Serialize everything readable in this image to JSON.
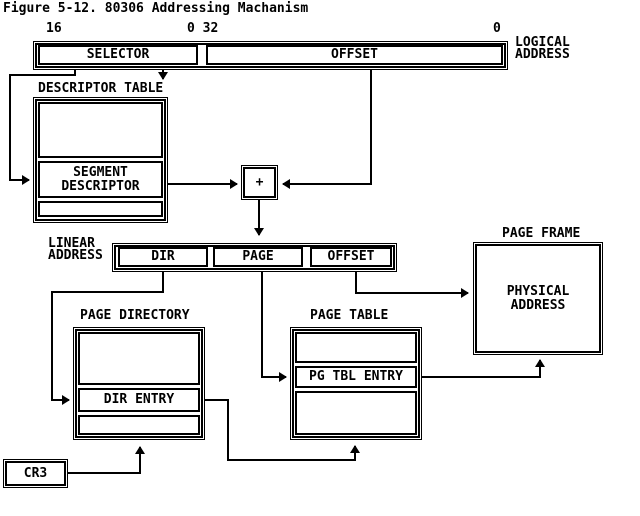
{
  "title": "Figure 5-12.  80306 Addressing Machanism",
  "colors": {
    "ink": "#000000",
    "background": "#ffffff"
  },
  "logical_address": {
    "bit_label_left": "16",
    "bit_label_middle": "0 32",
    "bit_label_right": "0",
    "selector_label": "SELECTOR",
    "offset_label": "OFFSET",
    "caption": "LOGICAL\nADDRESS"
  },
  "descriptor_table": {
    "title": "DESCRIPTOR TABLE",
    "segment_descriptor_label": "SEGMENT\nDESCRIPTOR"
  },
  "adder": {
    "plus_label": "+"
  },
  "linear_address": {
    "caption": "LINEAR\nADDRESS",
    "dir_label": "DIR",
    "page_label": "PAGE",
    "offset_label": "OFFSET"
  },
  "page_frame": {
    "title": "PAGE FRAME",
    "physical_address_label": "PHYSICAL\nADDRESS"
  },
  "page_directory": {
    "title": "PAGE DIRECTORY",
    "dir_entry_label": "DIR ENTRY"
  },
  "page_table": {
    "title": "PAGE TABLE",
    "pg_tbl_entry_label": "PG TBL ENTRY"
  },
  "cr3": {
    "label": "CR3"
  }
}
